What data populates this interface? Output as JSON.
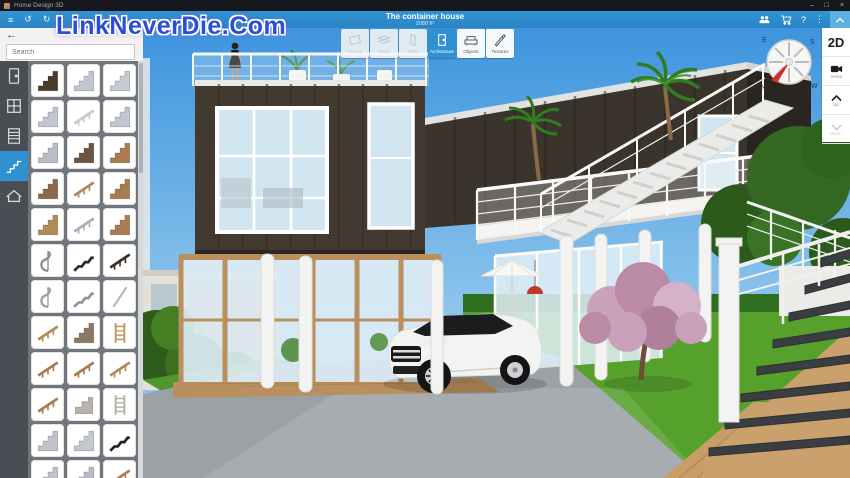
{
  "window": {
    "title": "Home Design 3D",
    "controls": [
      {
        "name": "minimize",
        "label": "–"
      },
      {
        "name": "maximize",
        "label": "□"
      },
      {
        "name": "close",
        "label": "×"
      }
    ]
  },
  "watermark": {
    "text": "LinkNeverDie.Com",
    "color": "#2b4ed8"
  },
  "toolbar": {
    "project_title": "The container house",
    "project_area": "2088 ft²",
    "left_icons": [
      {
        "name": "menu",
        "label": "≡"
      },
      {
        "name": "undo",
        "label": "↺"
      },
      {
        "name": "redo",
        "label": "↻"
      }
    ],
    "right_icons": [
      {
        "name": "community",
        "icon": "people"
      },
      {
        "name": "shop",
        "icon": "cart"
      },
      {
        "name": "help",
        "label": "?"
      },
      {
        "name": "more",
        "label": "⋮"
      }
    ],
    "collapse_icon": "chevron-up",
    "tabs": [
      {
        "label": "Rooms",
        "icon": "rooms",
        "state": "disabled"
      },
      {
        "label": "Floors",
        "icon": "floors",
        "state": "disabled"
      },
      {
        "label": "Walls",
        "icon": "walls",
        "state": "disabled"
      },
      {
        "label": "Architecture",
        "icon": "door",
        "state": "selected"
      },
      {
        "label": "Objects",
        "icon": "armchair",
        "state": "normal"
      },
      {
        "label": "Textures",
        "icon": "brush",
        "state": "normal"
      }
    ]
  },
  "sidebar": {
    "back_label": "←",
    "search_placeholder": "Search",
    "categories": [
      {
        "name": "doors",
        "icon": "cat-door",
        "selected": false
      },
      {
        "name": "windows",
        "icon": "cat-window",
        "selected": false
      },
      {
        "name": "shutters",
        "icon": "cat-shutter",
        "selected": false
      },
      {
        "name": "stairs",
        "icon": "cat-stairs",
        "selected": true
      },
      {
        "name": "roofs",
        "icon": "cat-roof",
        "selected": false
      }
    ],
    "thumbnails": [
      {
        "name": "stair-landing-dark",
        "kind": "stair",
        "color": "#4a3a2c"
      },
      {
        "name": "stair-concrete-wedge",
        "kind": "stair",
        "color": "#c2c6d2"
      },
      {
        "name": "stair-concrete-rail",
        "kind": "stair",
        "color": "#c6cad4"
      },
      {
        "name": "stair-concrete-wide",
        "kind": "stair",
        "color": "#c2c6d2"
      },
      {
        "name": "stair-slab",
        "kind": "rail",
        "color": "#c6c9d3"
      },
      {
        "name": "stair-bent",
        "kind": "stair",
        "color": "#c2c5cf"
      },
      {
        "name": "stair-thin-rail",
        "kind": "stair",
        "color": "#b9bdc9"
      },
      {
        "name": "stair-dark-rail",
        "kind": "stair",
        "color": "#6b5440"
      },
      {
        "name": "stair-wood-rail",
        "kind": "stair",
        "color": "#a87c50"
      },
      {
        "name": "stair-balustrade",
        "kind": "stair",
        "color": "#8a6a48"
      },
      {
        "name": "stair-wood-straight",
        "kind": "rail",
        "color": "#b08a58"
      },
      {
        "name": "stair-wood-rail-2",
        "kind": "stair",
        "color": "#a87c50"
      },
      {
        "name": "stair-l-shaped-wood",
        "kind": "stair",
        "color": "#b08a58"
      },
      {
        "name": "stair-metal-thin",
        "kind": "rail",
        "color": "#aab0ba"
      },
      {
        "name": "stair-wood-landing",
        "kind": "stair",
        "color": "#a87c50"
      },
      {
        "name": "stair-spiral-small",
        "kind": "spiral",
        "color": "#8a8f98"
      },
      {
        "name": "stair-zigzag-dark",
        "kind": "zigzag",
        "color": "#2e2a26"
      },
      {
        "name": "stair-straight-dark",
        "kind": "rail",
        "color": "#3a3028"
      },
      {
        "name": "stair-spiral",
        "kind": "spiral",
        "color": "#9aa0aa"
      },
      {
        "name": "stair-stringer-metal",
        "kind": "zigzag",
        "color": "#8f959f"
      },
      {
        "name": "handrail-pole",
        "kind": "pole",
        "color": "#b4b8c0"
      },
      {
        "name": "handrail-curved",
        "kind": "rail",
        "color": "#b08a58"
      },
      {
        "name": "stair-roofed",
        "kind": "stair",
        "color": "#8a7a64"
      },
      {
        "name": "ladder-wood",
        "kind": "ladder",
        "color": "#c09860"
      },
      {
        "name": "railing-wood-1",
        "kind": "rail",
        "color": "#a87c50"
      },
      {
        "name": "railing-wood-2",
        "kind": "rail",
        "color": "#a87c50"
      },
      {
        "name": "railing-wood-3",
        "kind": "rail",
        "color": "#b08a58"
      },
      {
        "name": "railing-curved-ornate",
        "kind": "rail",
        "color": "#a87c50"
      },
      {
        "name": "steps-stone-block",
        "kind": "block",
        "color": "#b8b4ac"
      },
      {
        "name": "ladder-roll",
        "kind": "ladder",
        "color": "#b4b0a8"
      },
      {
        "name": "stair-gray-1",
        "kind": "stair",
        "color": "#c0c3cc"
      },
      {
        "name": "stair-gray-2",
        "kind": "stair",
        "color": "#c4c7d0"
      },
      {
        "name": "stair-zigzag-black",
        "kind": "zigzag",
        "color": "#222222"
      },
      {
        "name": "stair-partial-1",
        "kind": "stair",
        "color": "#c0c3cc"
      },
      {
        "name": "stair-partial-2",
        "kind": "stair",
        "color": "#b8bcc6"
      },
      {
        "name": "stair-partial-3",
        "kind": "rail",
        "color": "#a87c50"
      }
    ]
  },
  "view_controls": {
    "mode_label": "2D",
    "camera_label": "Aerial",
    "up_label": "Up",
    "down_label": "Down"
  },
  "compass": {
    "n": "N",
    "e": "E",
    "s": "S",
    "w": "W"
  },
  "colors": {
    "accent": "#2f90d2",
    "toolbar_blue": "#3194d6",
    "titlebar": "#17171e",
    "sky_top": "#3e94de",
    "sky_bottom": "#8cc4ec",
    "grass": "#56a02c",
    "hedge": "#2f6e1e",
    "concrete": "#9ba1a5",
    "house": "#423a31",
    "house2": "#3b342d",
    "wood": "#b98f5d",
    "deck": "#c79e68",
    "glass": "#d2e6f2"
  }
}
